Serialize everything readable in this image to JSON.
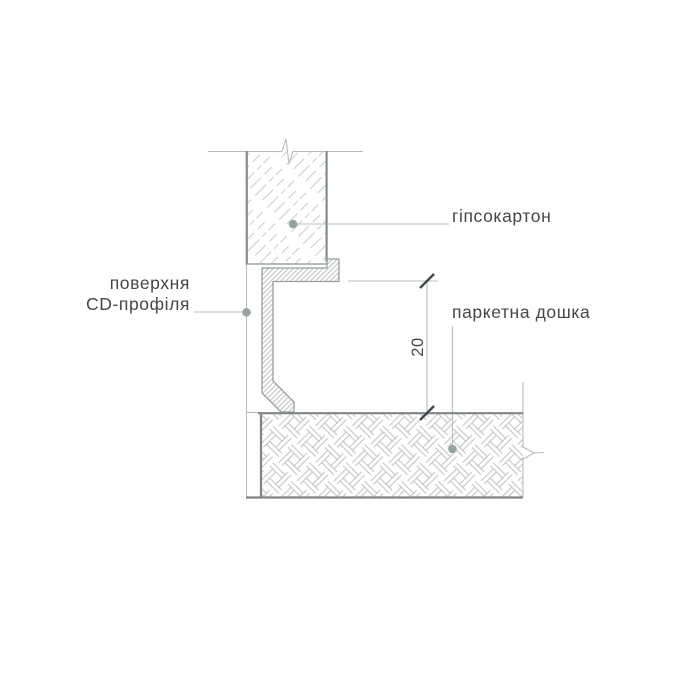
{
  "drawing": {
    "labels": {
      "gypsum": "гіпсокартон",
      "profile_surface_line1": "поверхня",
      "profile_surface_line2": "CD-профіля",
      "parquet": "паркетна дошка"
    },
    "dimension": {
      "value": "20",
      "units": "mm"
    },
    "colors": {
      "background": "#ffffff",
      "outline_dark": "#868c8c",
      "outline_medium": "#989d9d",
      "thin_line": "#b6bcba",
      "hatch_light": "#c4c8c8",
      "weave_hatch": "#bcc0c0",
      "steel_hatch": "#b2b6b6",
      "dimension_tick": "#40474a",
      "leader_dot": "#99a1a1",
      "text": "#43474c"
    }
  }
}
